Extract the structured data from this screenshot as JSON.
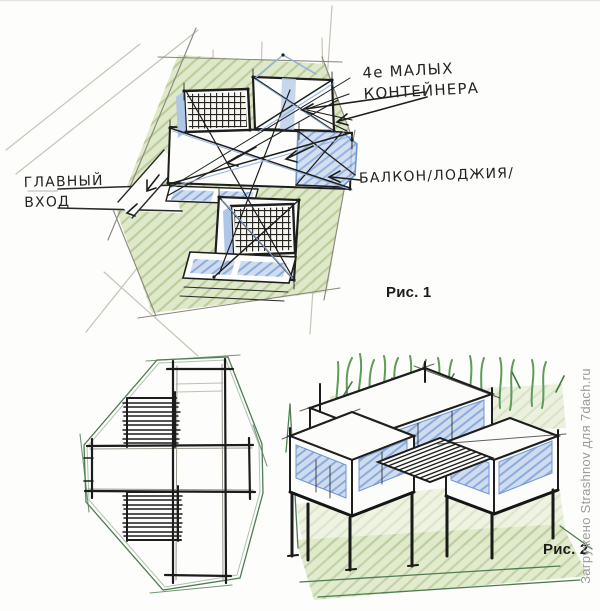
{
  "figure1": {
    "caption": "Рис. 1",
    "labels": {
      "containers": "4е МАЛЫХ\nКОНТЕЙНЕРА",
      "entrance": "ГЛАВНЫЙ\nВХОД",
      "balcony": "БАЛКОН/ЛОДЖИЯ/"
    }
  },
  "figure2": {
    "caption": "Рис. 2"
  },
  "watermark": "Загружено Strashnov для 7dach.ru",
  "colors": {
    "paper": "#fdfdfb",
    "ink": "#1e1e1e",
    "pencil": "#c8c3b8",
    "green_fill": "#dce6c4",
    "green_hatch": "#a9c185",
    "green_outline": "#4e7d52",
    "blue_fill": "#cfdcf0",
    "blue_hatch": "#7fa3d8",
    "watermark_gray": "#9b9b9b"
  }
}
